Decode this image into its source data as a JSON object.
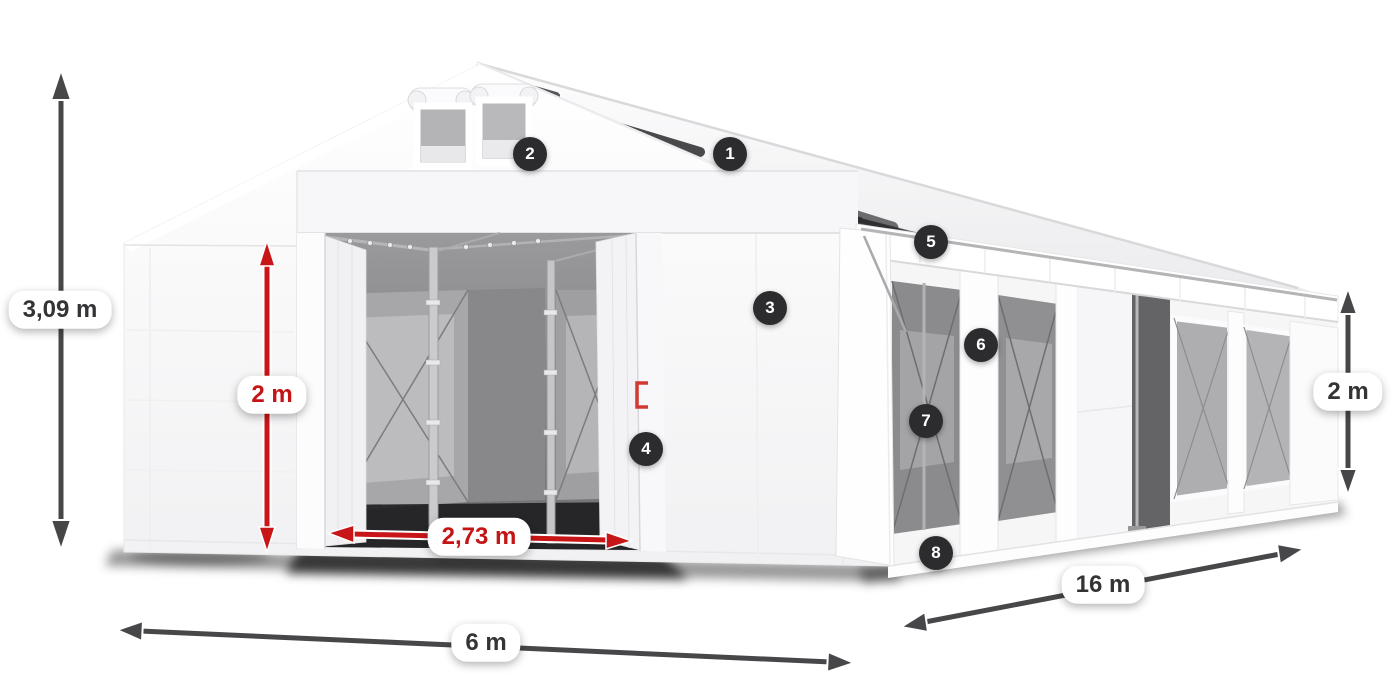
{
  "diagram": {
    "background_color": "#ffffff",
    "subject": "white marquee storage tent with dimension annotations and numbered part callouts",
    "accent_red": "#c41414",
    "annotation_dark": "#47474a",
    "badge_bg": "#2c2c2f",
    "badge_text_color": "#ffffff"
  },
  "dimensions": [
    {
      "id": "total-height",
      "label": "3,09 m",
      "color": "dark"
    },
    {
      "id": "door-height",
      "label": "2 m",
      "color": "red"
    },
    {
      "id": "door-width",
      "label": "2,73 m",
      "color": "red"
    },
    {
      "id": "front-width",
      "label": "6 m",
      "color": "dark"
    },
    {
      "id": "side-length",
      "label": "16 m",
      "color": "dark"
    },
    {
      "id": "side-height",
      "label": "2 m",
      "color": "dark"
    }
  ],
  "callouts": [
    {
      "number": "1"
    },
    {
      "number": "2"
    },
    {
      "number": "3"
    },
    {
      "number": "4"
    },
    {
      "number": "5"
    },
    {
      "number": "6"
    },
    {
      "number": "7"
    },
    {
      "number": "8"
    }
  ]
}
